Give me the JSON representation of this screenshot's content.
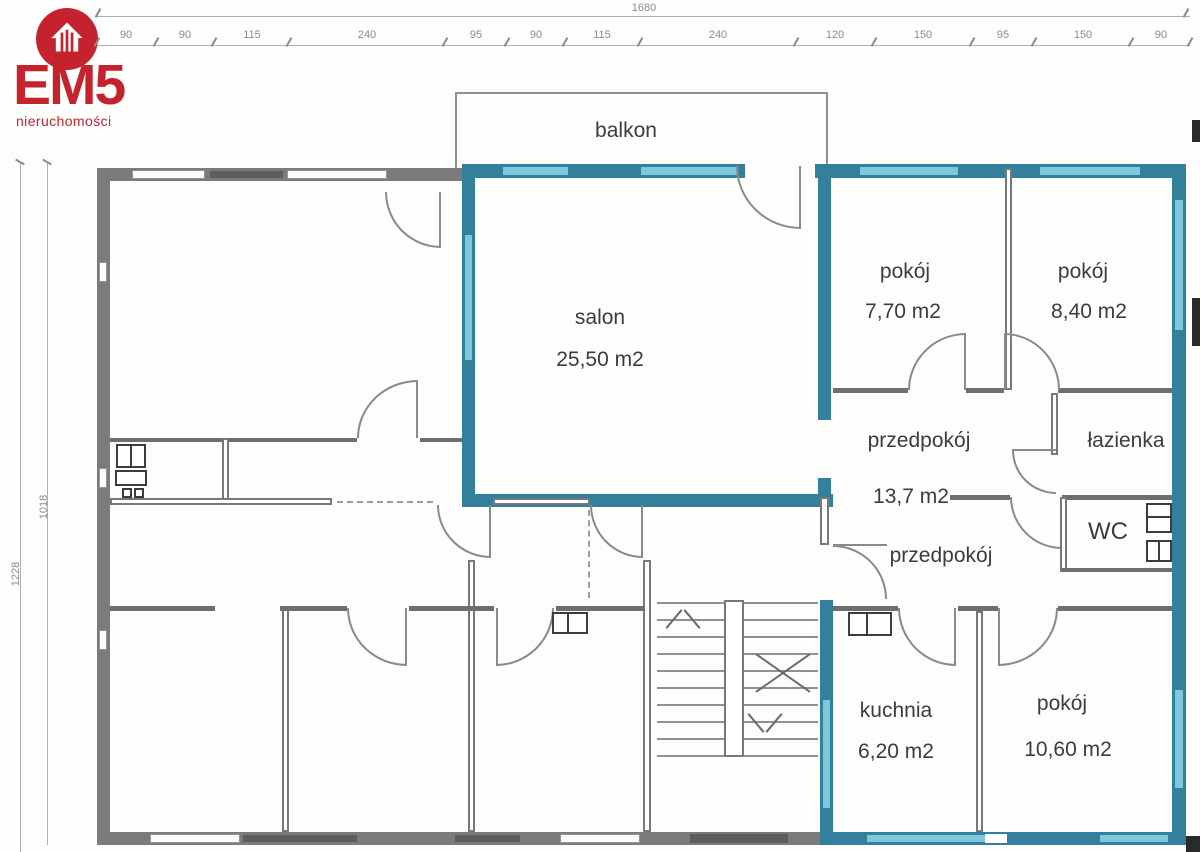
{
  "logo": {
    "title": "EM5",
    "subtitle": "nieruchomości",
    "icon": "house-icon",
    "accent_red": "#c4232e"
  },
  "dimensions": {
    "total_width": "1680",
    "top_segments": [
      "90",
      "90",
      "115",
      "240",
      "95",
      "90",
      "115",
      "240",
      "120",
      "150",
      "95",
      "150",
      "90"
    ],
    "left_outer": "1228",
    "left_inner": "1018"
  },
  "rooms": {
    "balkon": {
      "label": "balkon"
    },
    "salon": {
      "label": "salon",
      "area": "25,50 m2"
    },
    "pokoj1": {
      "label": "pokój",
      "area": "7,70 m2"
    },
    "pokoj2": {
      "label": "pokój",
      "area": "8,40 m2"
    },
    "przedpokoj": {
      "label": "przedpokój",
      "area": "13,7 m2"
    },
    "lazienka": {
      "label": "łazienka"
    },
    "wc": {
      "label": "WC"
    },
    "przedpokoj2": {
      "label": "przedpokój"
    },
    "kuchnia": {
      "label": "kuchnia",
      "area": "6,20 m2"
    },
    "pokoj3": {
      "label": "pokój",
      "area": "10,60 m2"
    }
  },
  "colors": {
    "highlight_teal": "#33809c",
    "window_blue": "#7fc8dc",
    "wall_gray": "#7b7b7b",
    "accent_red": "#c4232e"
  }
}
